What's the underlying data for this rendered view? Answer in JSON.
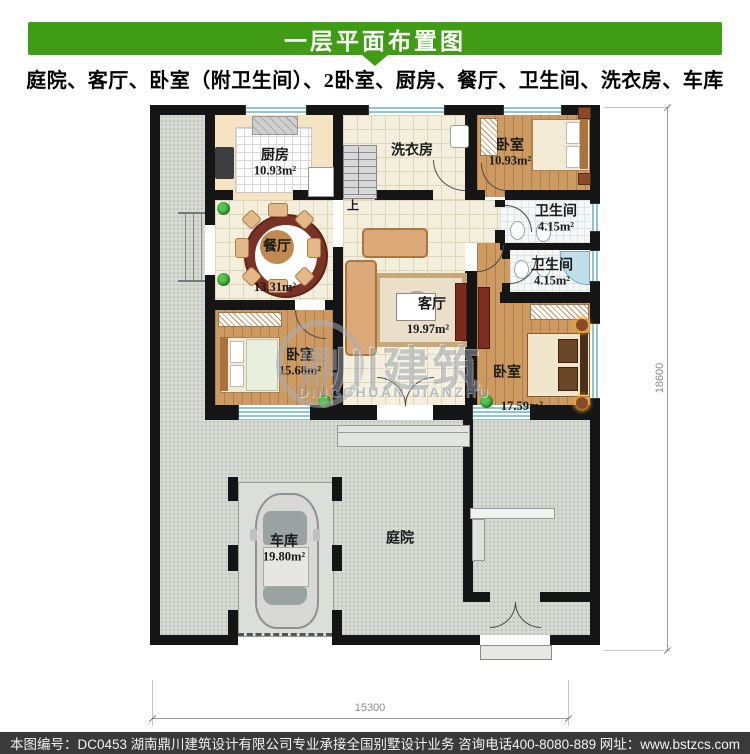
{
  "header": {
    "title": "一层平面布置图",
    "subtitle": "庭院、客厅、卧室（附卫生间）、2卧室、厨房、餐厅、卫生间、洗衣房、车库"
  },
  "plan": {
    "rooms": [
      {
        "id": "kitchen",
        "name": "厨房",
        "area": "10.93m²"
      },
      {
        "id": "laundry",
        "name": "洗衣房",
        "area": ""
      },
      {
        "id": "bedroom-top",
        "name": "卧室",
        "area": "10.93m²"
      },
      {
        "id": "bath-1",
        "name": "卫生间",
        "area": "4.15m²"
      },
      {
        "id": "bath-2",
        "name": "卫生间",
        "area": "4.15m²"
      },
      {
        "id": "dining",
        "name": "餐厅",
        "area": "13.31m²"
      },
      {
        "id": "living",
        "name": "客厅",
        "area": "19.97m²"
      },
      {
        "id": "bedroom-left",
        "name": "卧室",
        "area": "15.68m²"
      },
      {
        "id": "bedroom-right",
        "name": "卧室",
        "area": "17.59m²"
      },
      {
        "id": "garage",
        "name": "车库",
        "area": "19.80m²"
      },
      {
        "id": "courtyard",
        "name": "庭院",
        "area": ""
      }
    ],
    "stair_up_label": "上",
    "dimensions": {
      "width": "15300",
      "height": "18600"
    }
  },
  "watermark": {
    "logo_char": "鼎",
    "cn": "川建筑",
    "en": "DINGCHUAN JIANZHU"
  },
  "footer": {
    "items": [
      "本图编号：DC0453",
      "湖南鼎川建筑设计有限公司专业承接全国别墅设计业务",
      "咨询电话400-8080-889",
      "网址：www.bstzcs.com"
    ]
  },
  "colors": {
    "accent": "#3f9c14",
    "wall": "#151515",
    "outdoor": "#d6d8d2",
    "tile": "#f4efdc",
    "tile_line": "#ded5b8",
    "wood": "#cd9a62",
    "kitchen": "#f5e3c2",
    "bath": "#f6f8f8",
    "window": "#8fc7ce",
    "footer_bg": "#3a3a3a",
    "dim": "#8a8a8a",
    "watermark": "#9aa2ac",
    "watermark_blue": "#8091b0"
  }
}
